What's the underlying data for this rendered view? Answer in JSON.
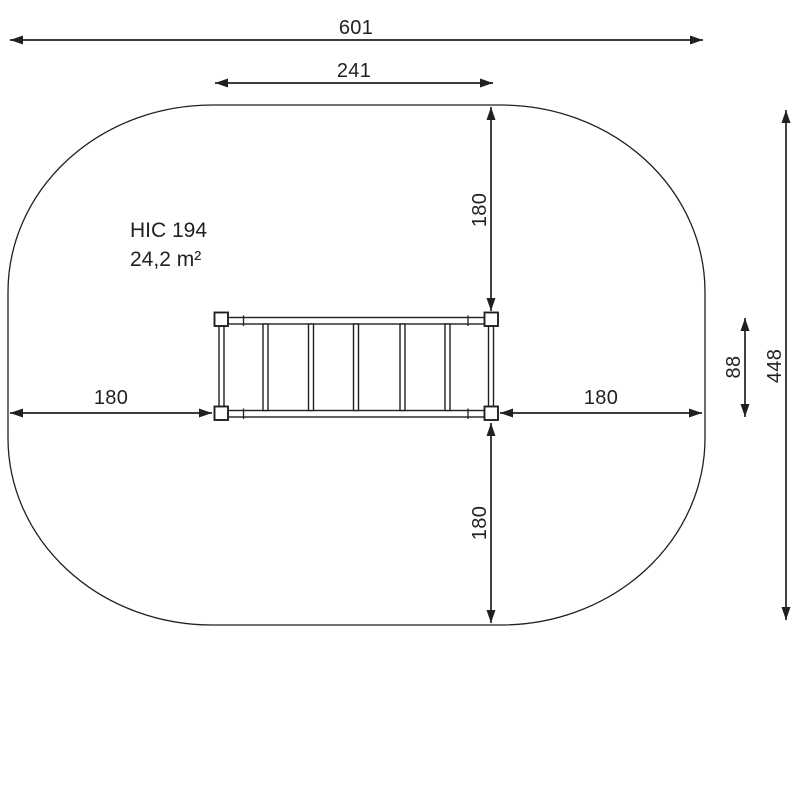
{
  "drawing": {
    "equipment_label": "HIC 194",
    "area_label": "24,2 m²",
    "dimensions": {
      "total_width": "601",
      "inner_width": "241",
      "top_clearance": "180",
      "left_clearance": "180",
      "right_clearance": "180",
      "bottom_clearance": "180",
      "equipment_depth": "88",
      "total_depth": "448"
    },
    "colors": {
      "ink": "#231f20",
      "background": "#ffffff"
    }
  }
}
